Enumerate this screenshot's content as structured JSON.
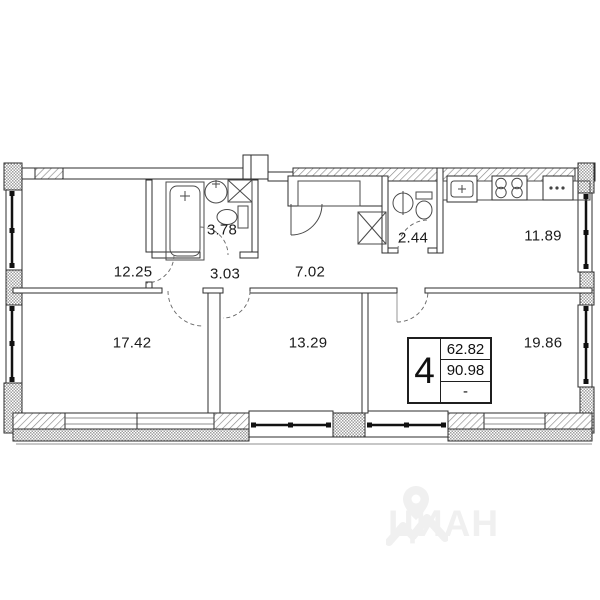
{
  "plan": {
    "rooms": [
      {
        "name": "room-top-left",
        "label": "12.25"
      },
      {
        "name": "bathroom",
        "label": "3.78"
      },
      {
        "name": "hallway-small",
        "label": "3.03"
      },
      {
        "name": "hallway-main",
        "label": "7.02"
      },
      {
        "name": "wc",
        "label": "2.44"
      },
      {
        "name": "kitchen",
        "label": "11.89"
      },
      {
        "name": "room-bottom-left",
        "label": "17.42"
      },
      {
        "name": "room-bottom-middle",
        "label": "13.29"
      },
      {
        "name": "room-bottom-right",
        "label": "19.86"
      }
    ],
    "info_box": {
      "rooms_count": "4",
      "living_area": "62.82",
      "total_area": "90.98",
      "kitchen_area": "-"
    }
  },
  "watermark": {
    "brand": "ЦИАН"
  },
  "colors": {
    "wall_line": "#2e2e2e",
    "hatch_line": "#8a8a8a",
    "label_text": "#1c1c1c",
    "watermark_gray": "#f0f0f0"
  }
}
